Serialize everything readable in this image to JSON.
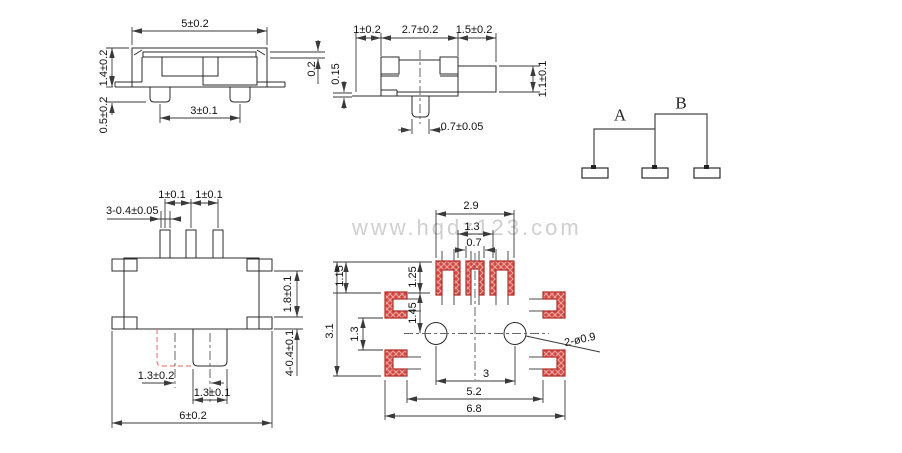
{
  "watermark": "www.hqdz123.com",
  "side_view": {
    "width": "5±0.2",
    "height": "1.4±0.2",
    "pin_height": "0.5±0.2",
    "pin_pitch": "3±0.1",
    "cover_thickness": "0.2"
  },
  "end_view": {
    "left_offset": "1±0.2",
    "body_width": "2.7±0.2",
    "knob_length": "1.5±0.2",
    "standoff": "0.15",
    "knob_height": "1.1±0.1",
    "pin_width": "0.7±0.05"
  },
  "schematic": {
    "pos_a": "A",
    "pos_b": "B"
  },
  "top_view": {
    "pin_pitch_left": "1±0.1",
    "pin_pitch_right": "1±0.1",
    "pin_note": "3-0.4±0.05",
    "lug_gap": "1.8±0.1",
    "lug_note": "4-0.4±0.1",
    "knob_travel": "1.3±0.2",
    "knob_width": "1.3±0.1",
    "overall_width": "6±0.2"
  },
  "pcb_layout": {
    "pad_span": "2.9",
    "pad_inner_gap": "1.3",
    "center_pad_width": "0.7",
    "row_offset": "1.15",
    "pad_height": "1.25",
    "pad_to_holes": "1.45",
    "side_pad_gap": "1.3",
    "total_height": "3.1",
    "hole_pitch": "3",
    "inner_span": "5.2",
    "outer_span": "6.8",
    "hole_note": "2-ø0.9"
  },
  "colors": {
    "line": "#2b2b2b",
    "pad_fill": "#d24a43",
    "pad_hatch": "#efa9a4",
    "pad_border": "#b22f2a",
    "alt_position": "#e8837f",
    "watermark": "#c7c7c7"
  }
}
